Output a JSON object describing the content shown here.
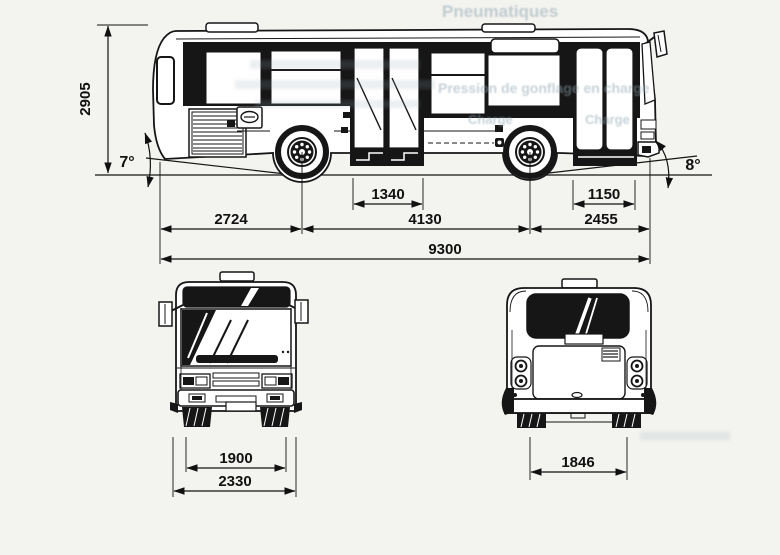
{
  "colors": {
    "paper": "#f3f3ef",
    "ink": "#161616",
    "ghost_text": "#8fa6b2"
  },
  "side_view": {
    "overall_height": "2905",
    "departure_angle": "7°",
    "approach_angle": "8°",
    "middle_door_width": "1340",
    "front_door_width": "1150",
    "rear_overhang": "2724",
    "wheelbase": "4130",
    "front_overhang": "2455",
    "overall_length": "9300"
  },
  "front_view": {
    "track_width": "1900",
    "overall_width": "2330"
  },
  "rear_view": {
    "rear_width": "1846"
  },
  "ghost_text": {
    "line1": "Pneumatiques",
    "line2": "Pression de gonflage en charge",
    "line3": "Charge",
    "line4": "Charge"
  }
}
